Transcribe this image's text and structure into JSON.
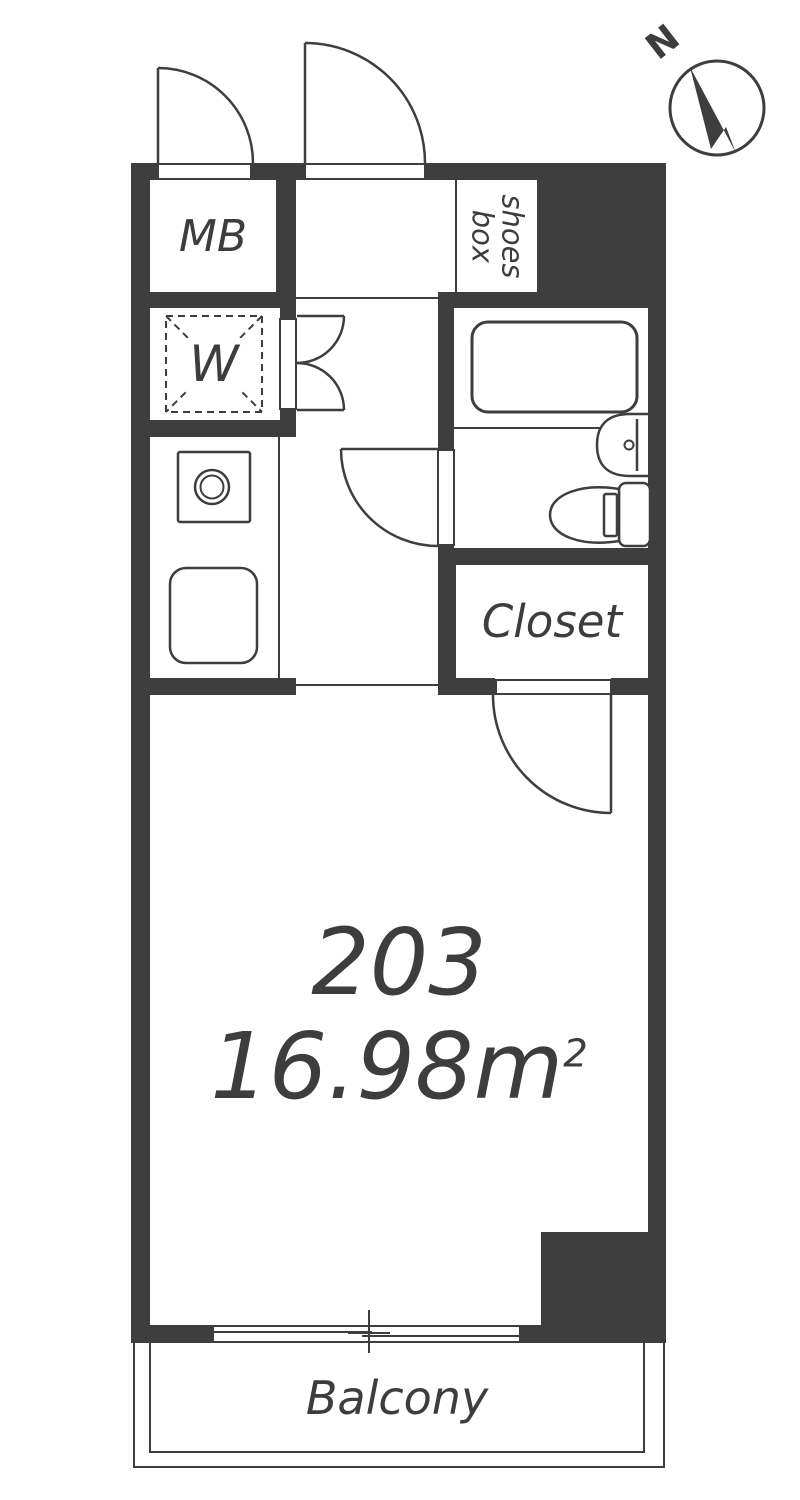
{
  "floorplan": {
    "unit_number": "203",
    "area_value": "16.98m",
    "area_exponent": "2",
    "rooms": {
      "mb_label": "MB",
      "washer_label": "W",
      "shoes_box_line1": "shoes",
      "shoes_box_line2": "box",
      "closet_label": "Closet",
      "balcony_label": "Balcony"
    },
    "compass": {
      "north_label": "N"
    },
    "colors": {
      "wall": "#3e3e3e",
      "line": "#3e3e3e",
      "text": "#3d3d3d",
      "background": "#ffffff"
    }
  }
}
